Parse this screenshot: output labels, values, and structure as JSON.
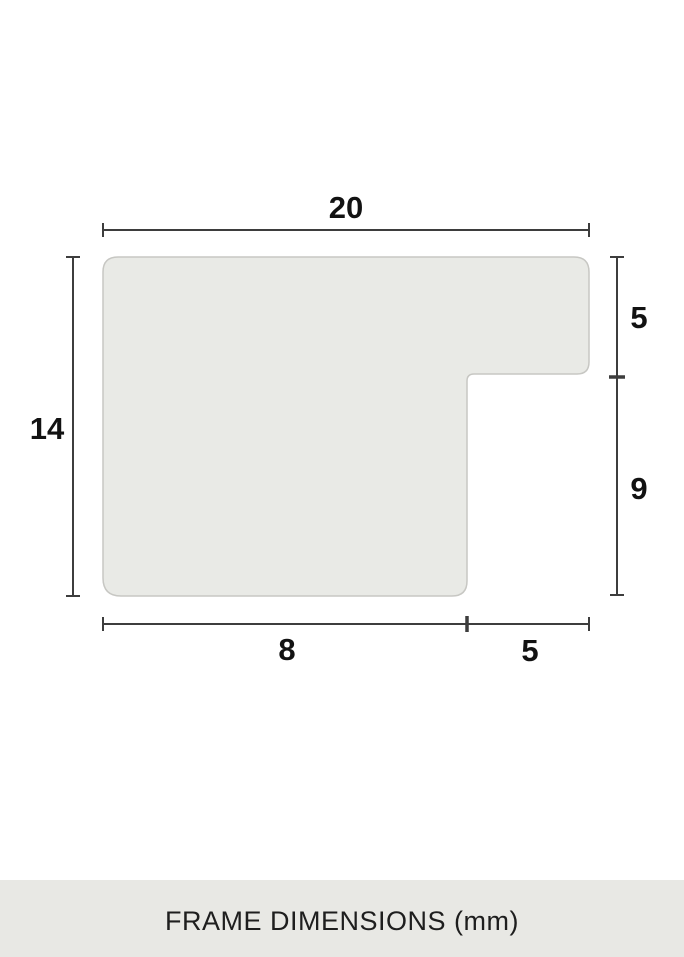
{
  "diagram": {
    "description": "frame-moulding-profile-cross-section",
    "dimension_labels": {
      "top_width": "20",
      "left_height": "14",
      "right_upper_height": "5",
      "right_lower_height": "9",
      "bottom_inner_width": "8",
      "bottom_outer_width": "5"
    },
    "colors": {
      "background": "#ffffff",
      "profile_fill": "#e9eae6",
      "profile_stroke": "#c7c7c3",
      "dimension_line": "#3d3d3d",
      "label_text": "#121212",
      "footer_background": "#e8e8e4",
      "footer_text": "#1e1e1e"
    }
  },
  "footer": {
    "caption": "FRAME DIMENSIONS (mm)"
  }
}
